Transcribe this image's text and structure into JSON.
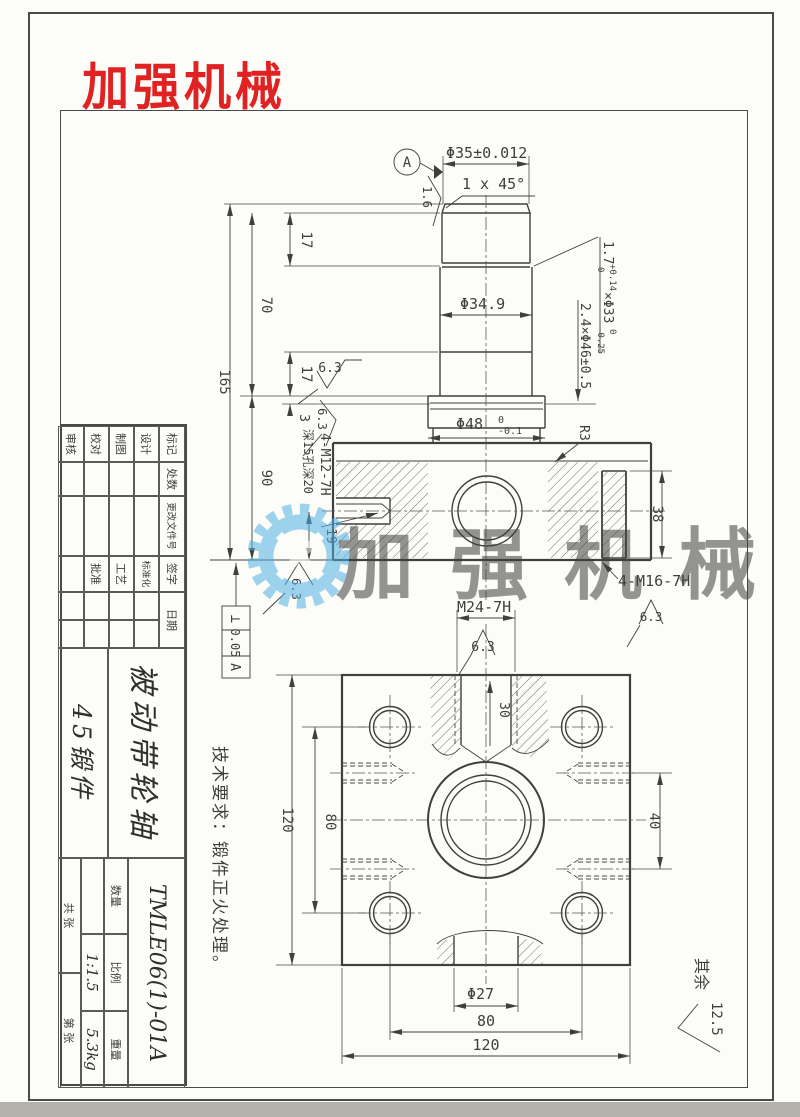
{
  "logo": {
    "text": "加强机械"
  },
  "watermark": {
    "text": "加强机械"
  },
  "colors": {
    "logo_red": "#e02222",
    "watermark_blue": "#4fb0e2",
    "line": "#4a4a4a"
  },
  "front_view": {
    "dia35": "Φ35±0.012",
    "chamfer": "1 x 45°",
    "datum_a": "A",
    "ra16": "1.6",
    "ra63": "6.3",
    "d17a": "17",
    "d70": "70",
    "d165": "165",
    "d17b": "17",
    "d3": "3",
    "d90": "90",
    "d19": "19",
    "d38": "38",
    "dia349": "Φ34.9",
    "groove1": {
      "w": "1.7",
      "wsup": "+0.14",
      "wsub": "0",
      "dia": "×Φ33",
      "dsup": "0",
      "dsub": "-0.25"
    },
    "groove2": "2.4×Φ46±0.5",
    "dia48": {
      "main": "Φ48",
      "sup": "0",
      "sub": "-0.1"
    },
    "r3": "R3",
    "m12": "4-M12-7H",
    "m12_depth": "深15孔深20",
    "m16": "4-M16-7H",
    "gdt": {
      "symbol": "⊥",
      "tolerance": "0.05",
      "datum": "A"
    }
  },
  "bottom_view": {
    "m24": "M24-7H",
    "d30": "30",
    "d120": "120",
    "d80": "80",
    "d40": "40",
    "dia27": "Φ27"
  },
  "notes": {
    "tech": "技术要求：锻件正火处理。",
    "other_prefix": "其余",
    "other_value": "12.5"
  },
  "title_block": {
    "h_biaoji": "标记",
    "h_chushu": "处数",
    "h_wenjian": "更改文件号",
    "h_qianzi": "签字",
    "h_riqi": "日期",
    "r_sheji": "设计",
    "r_zhitu": "制图",
    "r_jiaodui": "校对",
    "r_shenhe": "审核",
    "r_biaozhunhua": "标准化",
    "r_gongyi": "工艺",
    "r_pizhun": "批准",
    "part_name": "被动带轮轴",
    "material": "45锻件",
    "drawing_no": "TMLE06(1)-01A",
    "h_shuliang": "数量",
    "h_bili": "比例",
    "h_zhongliang": "重量",
    "v_bili": "1:1.5",
    "v_zhongliang": "5.3kg",
    "gong": "共  张",
    "di": "第  张"
  }
}
